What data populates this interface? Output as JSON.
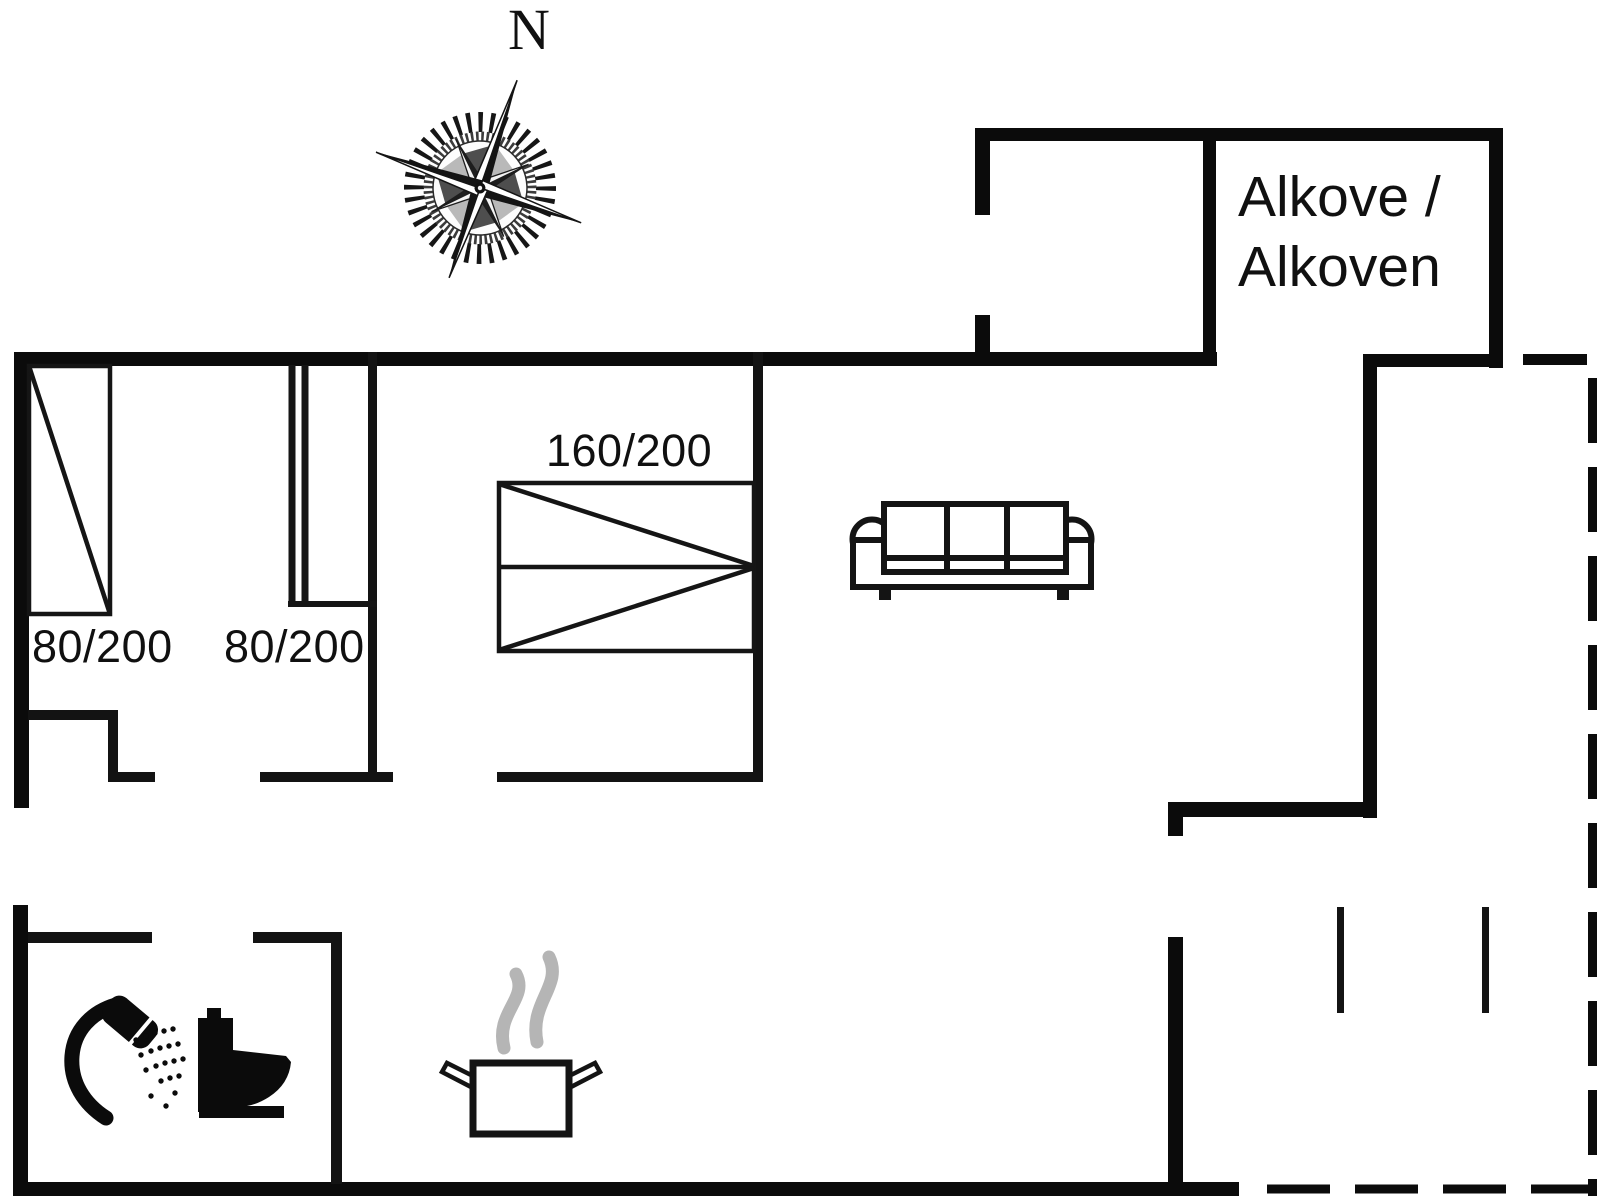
{
  "page": {
    "type": "holiday-home-floor-plan",
    "background_color": "#ffffff",
    "wall_color": "#0b0b0b",
    "interior_wall_color": "#131313",
    "steam_color": "#b5b5b5"
  },
  "compass": {
    "north_label": "N"
  },
  "rooms": {
    "alcove": {
      "label_line1": "Alkove /",
      "label_line2": "Alkoven"
    }
  },
  "furniture": {
    "bed_left": {
      "size_label": "80/200"
    },
    "bed_middle": {
      "size_label": "80/200"
    },
    "bed_double": {
      "size_label": "160/200"
    }
  },
  "icons": {
    "compass": "compass-rose-icon",
    "shower": "shower-icon",
    "toilet": "toilet-icon",
    "pot": "cooking-pot-icon",
    "steam": "steam-icon",
    "sofa": "sofa-icon"
  }
}
